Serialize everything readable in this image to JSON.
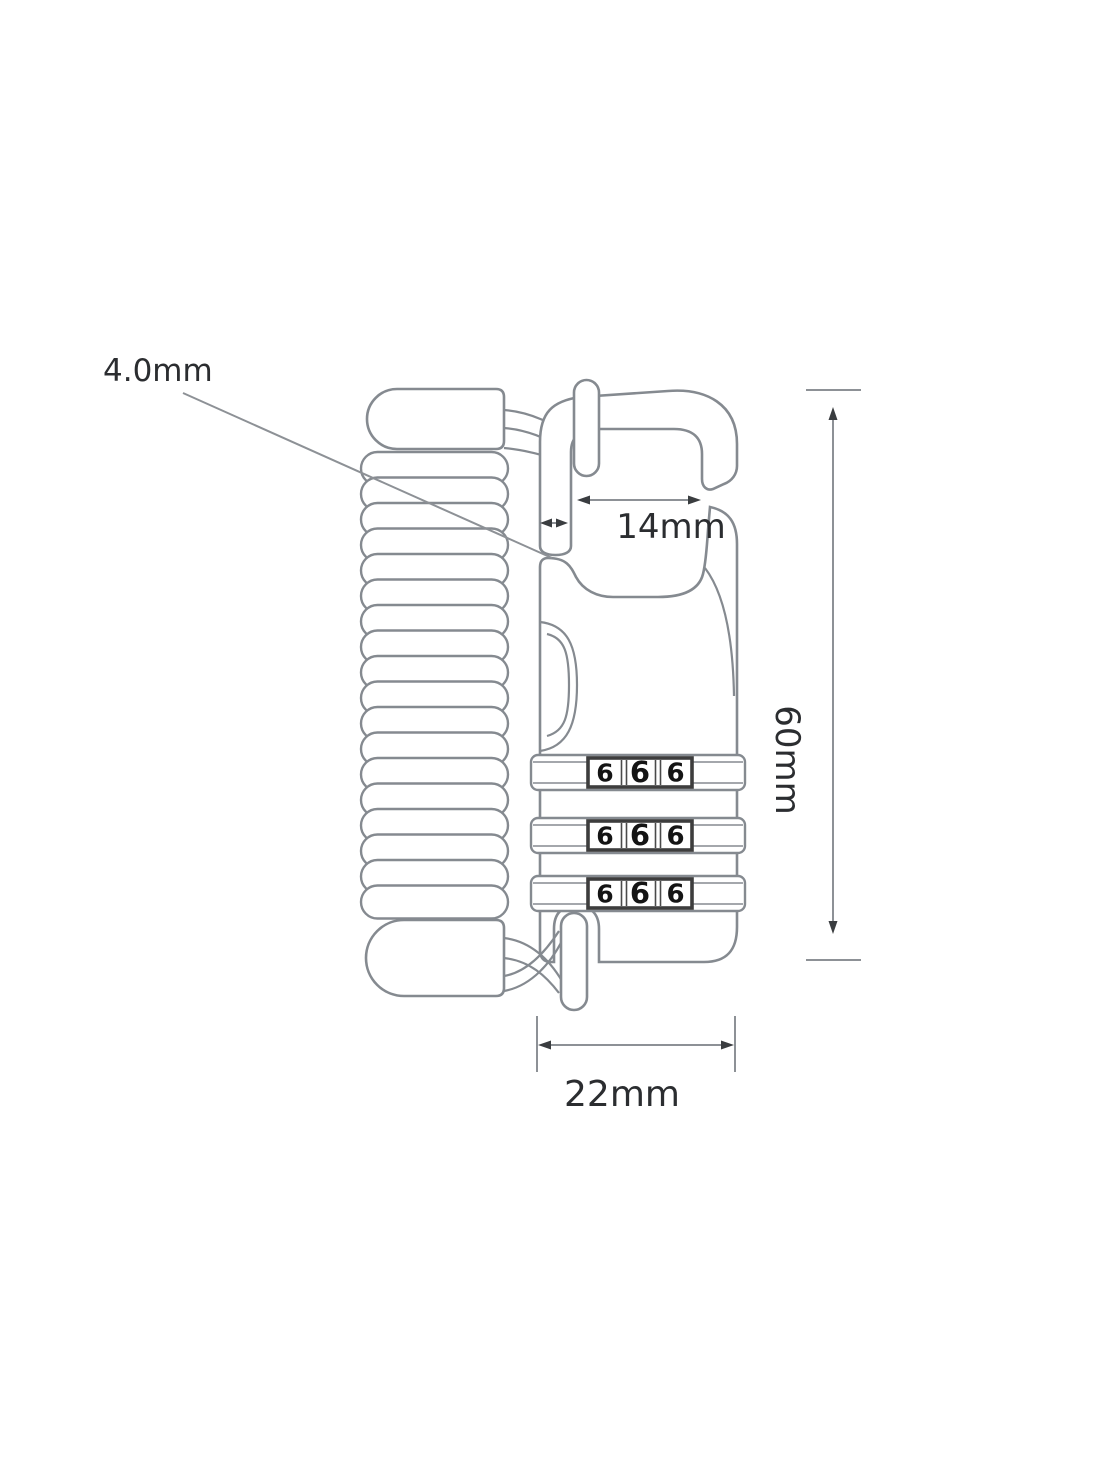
{
  "diagram": {
    "labels": {
      "cable_diameter": "4.0mm",
      "opening_width": "14mm",
      "body_height": "60mm",
      "body_width": "22mm"
    },
    "dials": {
      "rows": [
        {
          "digits": [
            "6",
            "6",
            "6"
          ]
        },
        {
          "digits": [
            "6",
            "6",
            "6"
          ]
        },
        {
          "digits": [
            "6",
            "6",
            "6"
          ]
        }
      ]
    },
    "colors": {
      "line": "#858a90",
      "dial_border": "#3d3d3d",
      "dial_separator": "#4a4a4a",
      "digit": "#141414",
      "dim_line": "#8d9196",
      "arrow": "#3a3d40",
      "dim_text": "#2b2d30",
      "background": "#ffffff"
    }
  }
}
